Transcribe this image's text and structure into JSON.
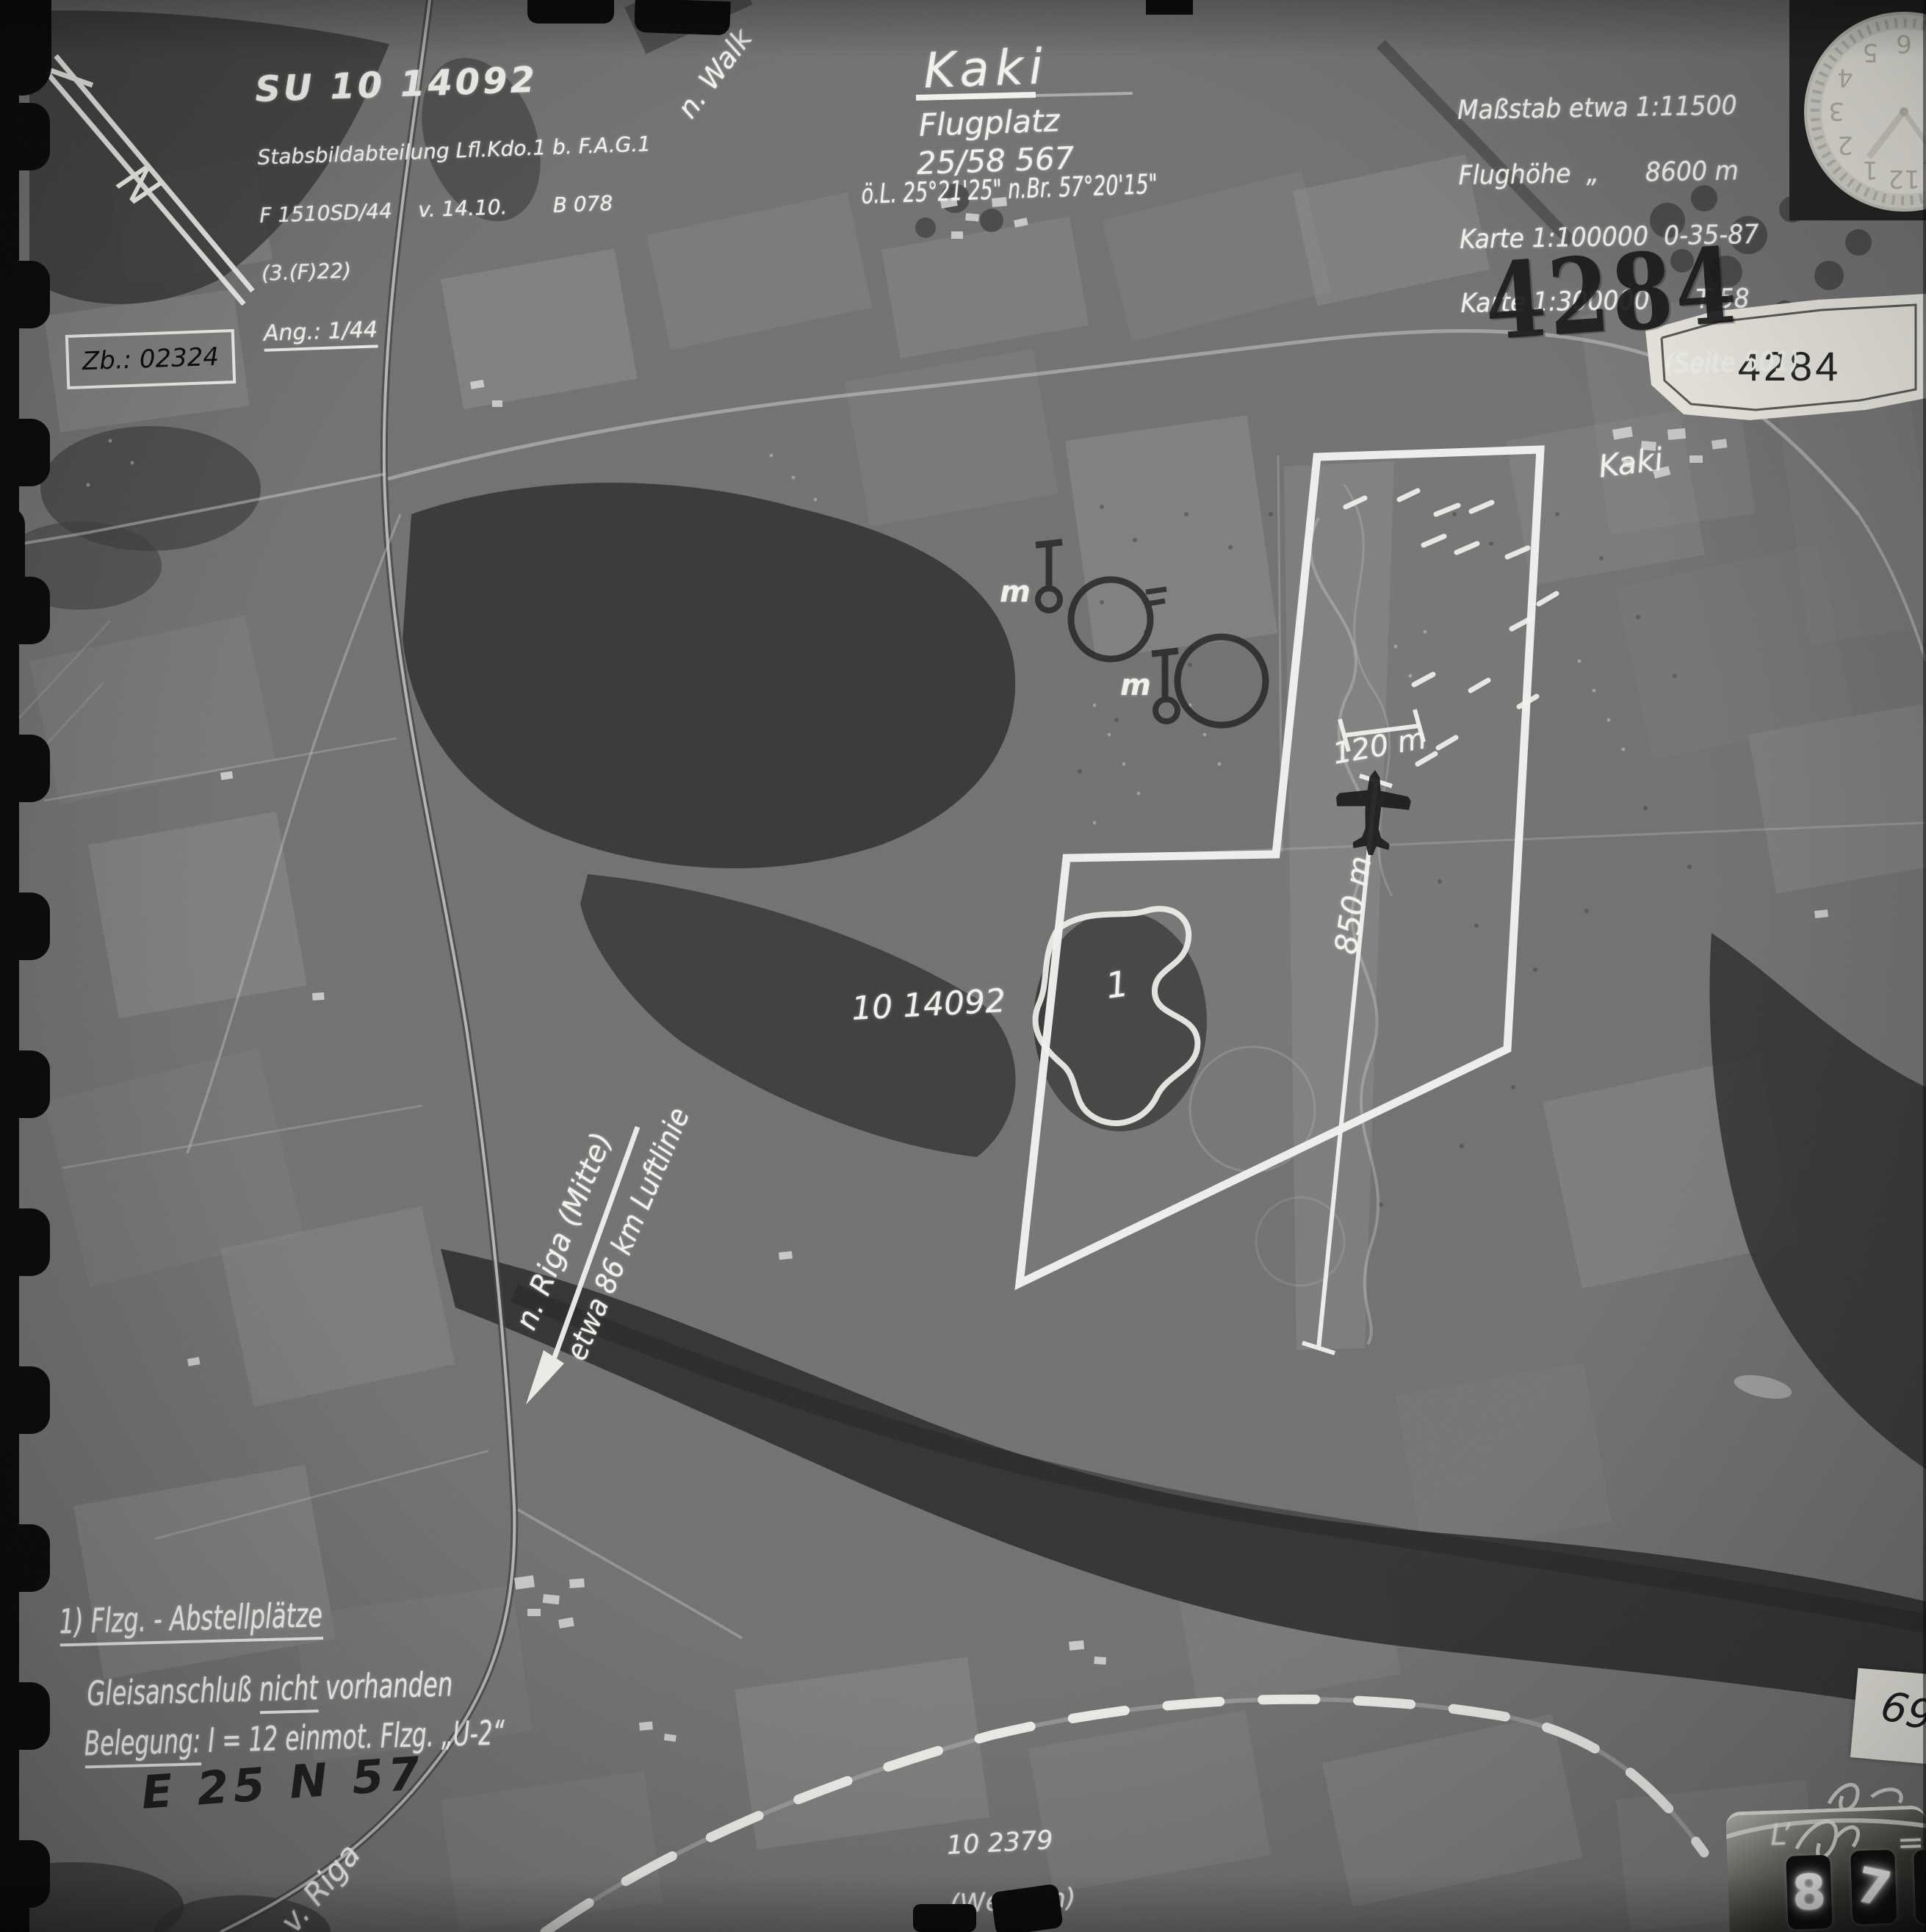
{
  "colors": {
    "annotation_ink": "#f3f3ee",
    "stamp_ink": "#101010",
    "label_paper": "#eeece4"
  },
  "annotations": {
    "north": "N",
    "sortie": {
      "line1": "SU 10 14092",
      "line2": "Stabsbildabteilung Lfl.Kdo.1 b. F.A.G.1",
      "line3": "F 1510SD/44    v. 14.10.       B 078",
      "line4": "(3.(F)22)",
      "line5": "Ang.: 1/44"
    },
    "zb_number": "Zb.: 02324",
    "rail_to": "n. Walk",
    "rail_from": "v. Riga",
    "target": {
      "name": "Kaki",
      "type": "Flugplatz",
      "number": "25/58 567",
      "coords": "ö.L. 25°21'25\" n.Br. 57°20'15\""
    },
    "info": {
      "scale": "Maßstab etwa 1:11500",
      "altitude": "Flughöhe  „      8600 m",
      "map100": "Karte 1:100000  0-35-87",
      "map300": "Karte 1:300000      T 58",
      "page": "(Seite 501)"
    },
    "stamp_number": "4284",
    "label_number": "4284",
    "village": "Kaki",
    "m_mark_1": "m",
    "m_mark_2": "m",
    "dim_width": "120 m",
    "dim_length": "850 m",
    "photo_id": "10 14092",
    "dispersal_number": "1",
    "riga_direction": "n. Riga (Mitte)",
    "riga_distance": "etwa 86 km Luftlinie",
    "grid_ref": "E 25 N 57",
    "adjacent_ref": "10 2379",
    "adjacent_name": "(Wenden)",
    "notes": {
      "line1": "1) Flzg. - Abstellplätze",
      "line2_a": "Gleisanschluß",
      "line2_b": "nicht",
      "line2_c": "vorhanden",
      "line3_a": "Belegung:",
      "line3_b": "I = 12 einmot. Flzg. „U-2“"
    },
    "tag_number": "69.",
    "counter": {
      "mark_left": "L’",
      "mark_right": "=",
      "digit_1": "8",
      "digit_2": "7"
    },
    "clock_numerals": [
      "1",
      "2",
      "3",
      "4",
      "5",
      "6",
      "7",
      "8",
      "9",
      "10",
      "11",
      "12"
    ]
  }
}
